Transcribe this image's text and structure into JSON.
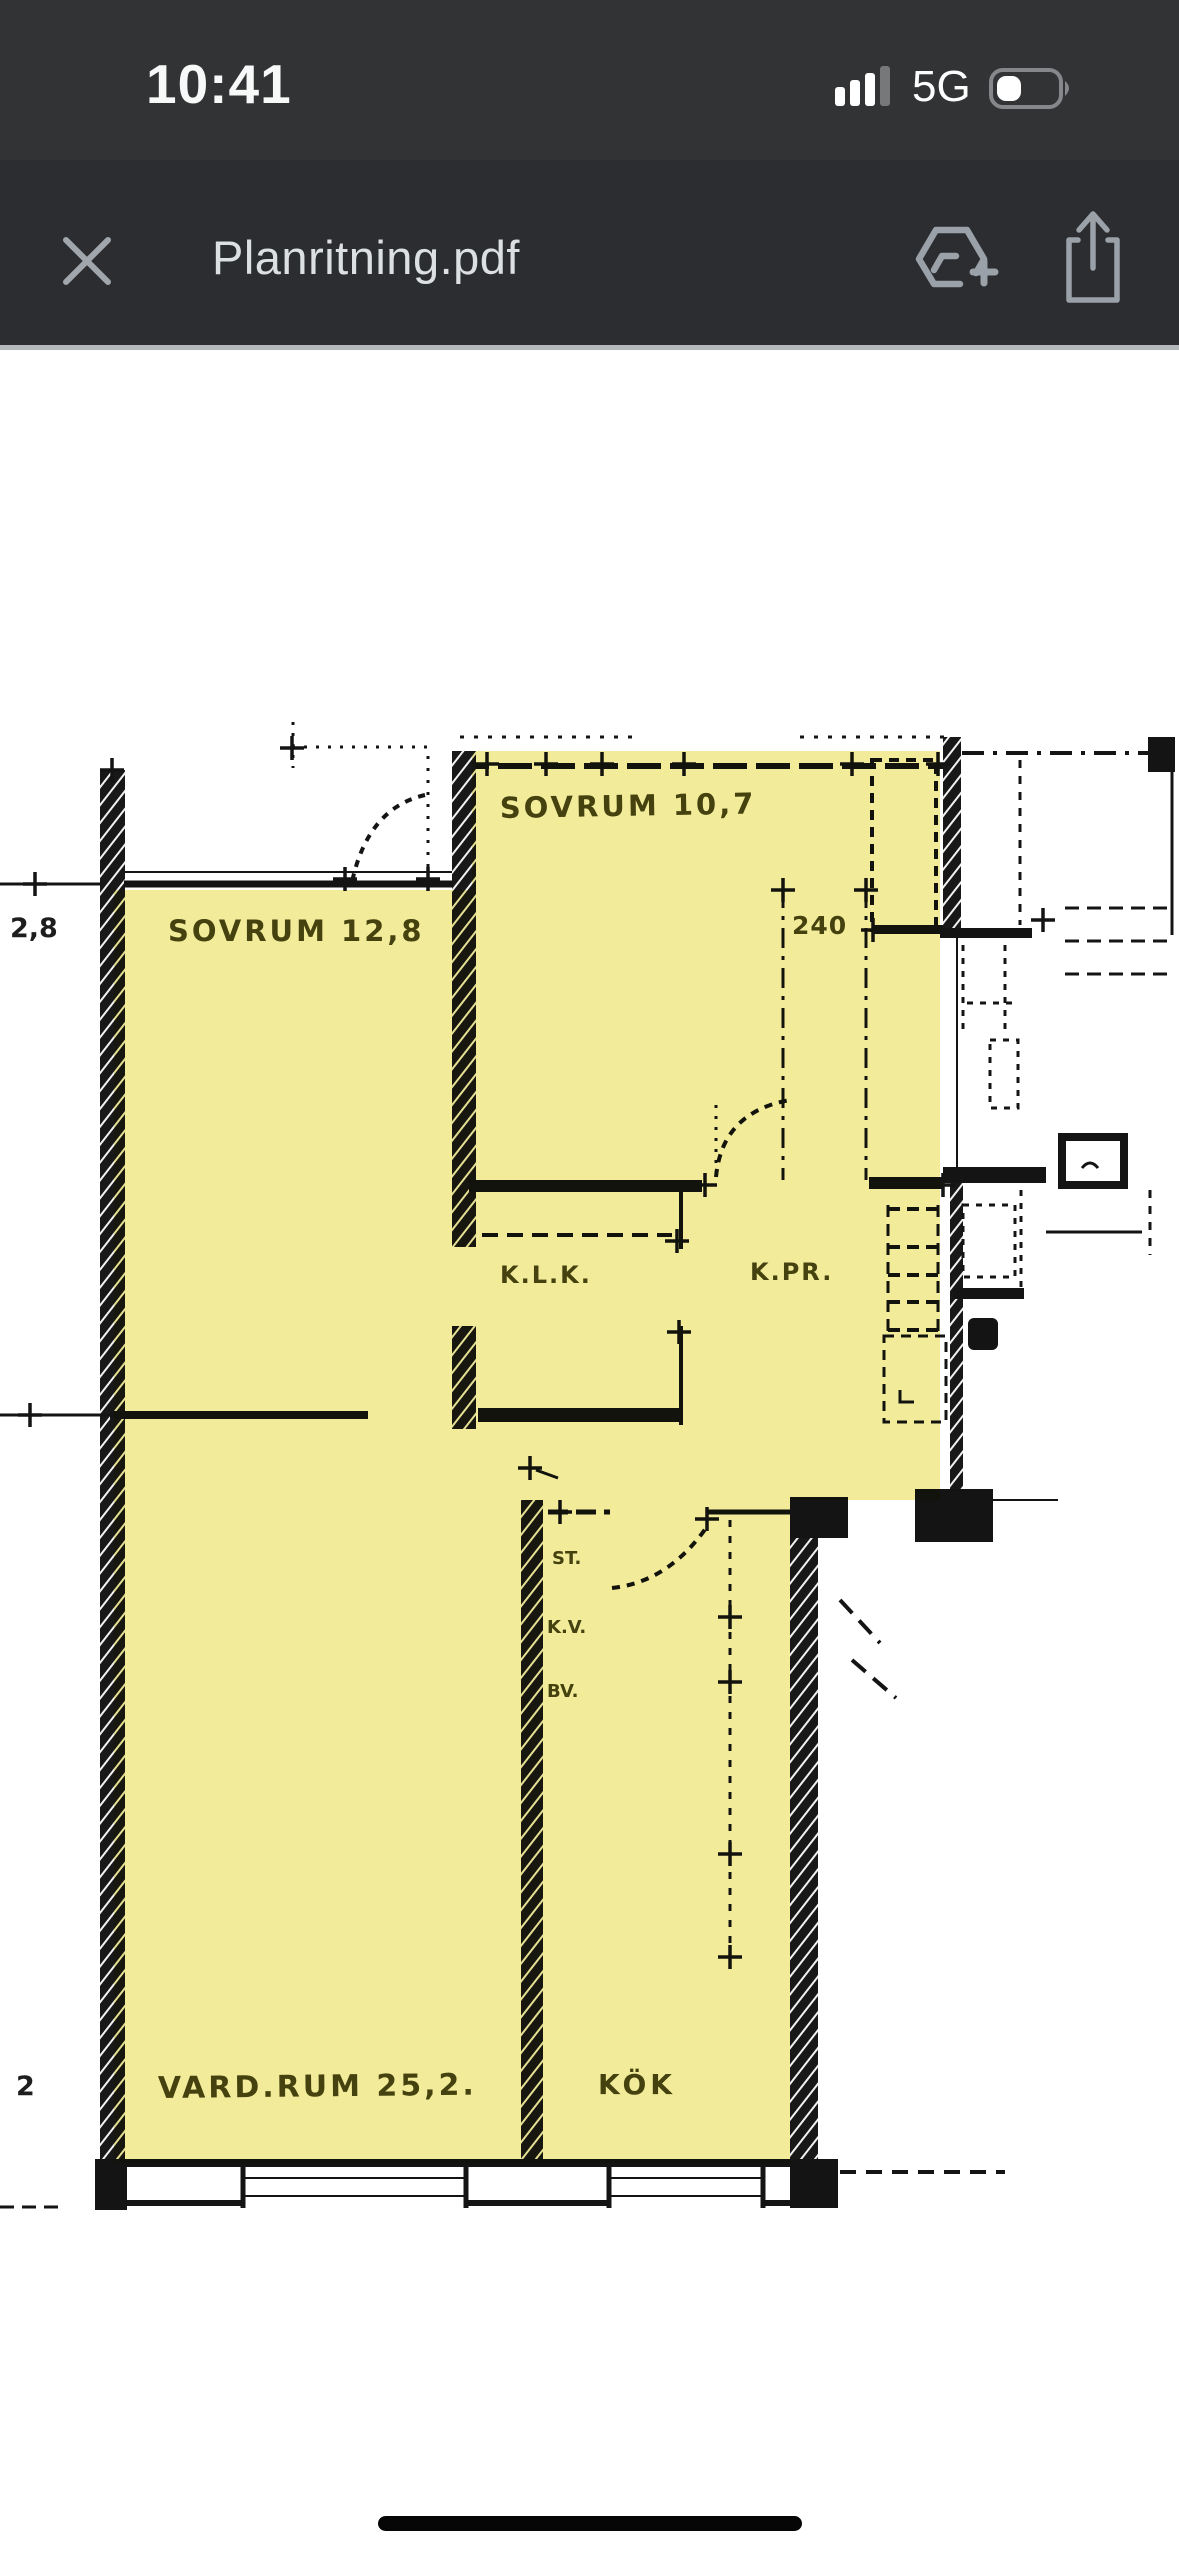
{
  "status_bar": {
    "time": "10:41",
    "network": "5G",
    "signal_icon": "cellular-signal-3-of-4-bars",
    "battery_icon": "battery-low-about-one-third"
  },
  "toolbar": {
    "title": "Planritning.pdf",
    "close_icon": "close-x",
    "drive_icon": "add-to-drive",
    "share_icon": "ios-share"
  },
  "document": {
    "type": "scanned floor plan with yellow room highlight",
    "highlight_color": "#f1ea8f",
    "ink_color": "#141414",
    "highlighted_ink_color": "#55501e",
    "room_labels": {
      "sovrum2": "SOVRUM 10,7",
      "sovrum1": "SOVRUM 12,8",
      "klk": "K.L.K.",
      "kpr": "K.PR.",
      "st": "ST.",
      "kv": "K.V.",
      "bv": "BV.",
      "vardagsrum": "VARD.RUM 25,2.",
      "kok": "KÖK"
    },
    "dimension_labels": {
      "dim28": "2,8",
      "dim240": "240",
      "dim2": "2"
    }
  }
}
